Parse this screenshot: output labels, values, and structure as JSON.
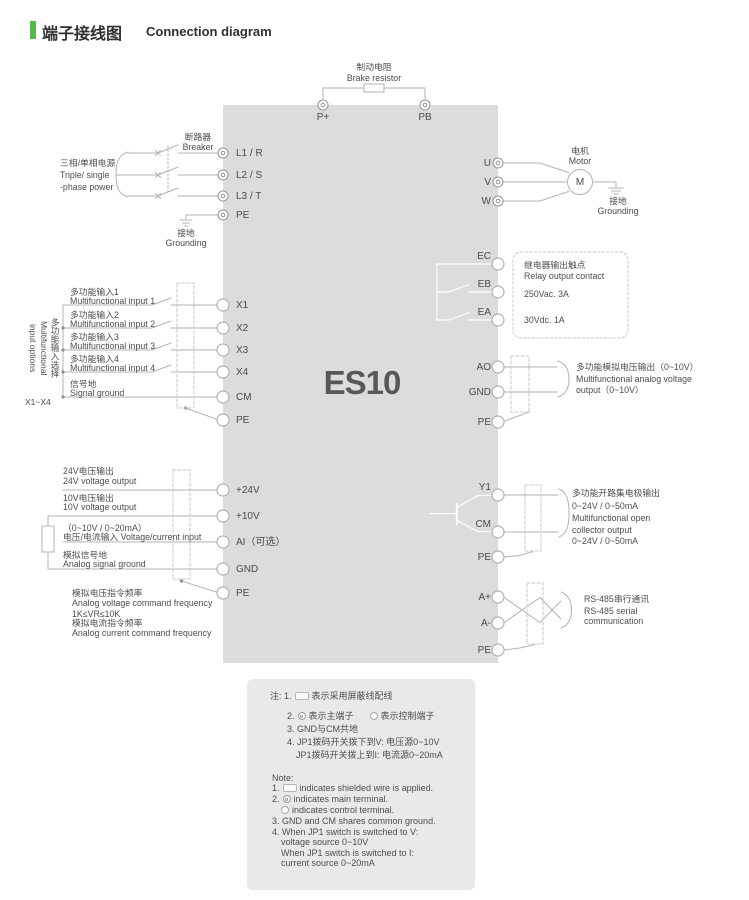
{
  "title": {
    "zh": "端子接线图",
    "en": "Connection diagram"
  },
  "device": {
    "model": "ES10"
  },
  "colors": {
    "accent": "#54b948",
    "device_box": "#dcdcdc",
    "notes_box": "#e9e9e9",
    "wire": "#b3b3b3",
    "text": "#4d4d4d"
  },
  "brake": {
    "zh": "制动电阻",
    "en": "Brake resistor",
    "p_plus": "P+",
    "pb": "PB"
  },
  "power": {
    "src_zh": "三相/单相电源",
    "src_en1": "Triple/ single",
    "src_en2": "-phase power",
    "breaker_zh": "断路器",
    "breaker_en": "Breaker",
    "l1": "L1 / R",
    "l2": "L2 / S",
    "l3": "L3 / T",
    "pe": "PE",
    "gnd_zh": "接地",
    "gnd_en": "Grounding"
  },
  "motor": {
    "u": "U",
    "v": "V",
    "w": "W",
    "zh": "电机",
    "en": "Motor",
    "symbol": "M",
    "gnd_zh": "接地",
    "gnd_en": "Grounding"
  },
  "inputs": {
    "side_label": "多功能输入选择\nMultifunctional\ninput options",
    "range": "X1~X4",
    "rows": [
      {
        "zh": "多功能输入1",
        "en": "Multifunctional input 1",
        "t": "X1"
      },
      {
        "zh": "多功能输入2",
        "en": "Multifunctional input 2",
        "t": "X2"
      },
      {
        "zh": "多功能输入3",
        "en": "Multifunctional input 3",
        "t": "X3"
      },
      {
        "zh": "多功能输入4",
        "en": "Multifunctional input 4",
        "t": "X4"
      },
      {
        "zh": "信号地",
        "en": "Signal ground",
        "t": "CM"
      }
    ],
    "pe": "PE"
  },
  "relay": {
    "ec": "EC",
    "eb": "EB",
    "ea": "EA",
    "zh": "继电器输出触点",
    "en": "Relay output contact",
    "ac": "250Vac. 3A",
    "dc": "30Vdc. 1A"
  },
  "analog_out": {
    "ao": "AO",
    "gnd": "GND",
    "pe": "PE",
    "zh": "多功能模拟电压输出（0~10V）",
    "en1": "Multifunctional analog voltage",
    "en2": "output（0~10V）"
  },
  "analog_in": {
    "rows": [
      {
        "zh": "24V电压输出",
        "en": "24V voltage output",
        "t": "+24V"
      },
      {
        "zh": "10V电压输出",
        "en": "10V voltage output",
        "t": "+10V"
      },
      {
        "zh": "（0~10V / 0~20mA）",
        "en": "电压/电流输入 Voltage/current input",
        "t": "AI（可选）"
      },
      {
        "zh": "模拟信号地",
        "en": "Analog signal ground",
        "t": "GND"
      }
    ],
    "pe": "PE",
    "freq1": "模拟电压指令频率",
    "freq2": "Analog voltage command frequency",
    "freq3": "1K≤VR≤10K",
    "freq4": "模拟电流指令频率",
    "freq5": "Analog current command frequency"
  },
  "collector": {
    "y1": "Y1",
    "cm": "CM",
    "pe": "PE",
    "l1": "多功能开路集电极输出",
    "l2": "0~24V / 0~50mA",
    "l3": "Multifunctional open",
    "l4": "collector output",
    "l5": "0~24V / 0~50mA"
  },
  "rs485": {
    "a_plus": "A+",
    "a_minus": "A-",
    "pe": "PE",
    "l1": "RS-485串行通讯",
    "l2": "RS-485 serial",
    "l3": "communication"
  },
  "notes": {
    "zh1a": "注: 1.",
    "zh1b": "表示采用屏蔽线配线",
    "zh2a": "2.",
    "zh2b": "表示主端子",
    "zh2c": "表示控制端子",
    "zh3": "3. GND与CM共地",
    "zh4": "4. JP1拨码开关拨下到V: 电压源0~10V",
    "zh5": "JP1拨码开关拨上到I: 电流源0~20mA",
    "en0": "Note:",
    "en1a": "1.",
    "en1b": "indicates shielded wire is applied.",
    "en2a": "2.",
    "en2b": "indicates main terminal.",
    "en3b": "indicates control terminal.",
    "en4": "3. GND and CM shares common ground.",
    "en5": "4. When JP1 switch is switched to V:",
    "en6": "voltage source 0~10V",
    "en7": "When JP1 switch is switched to I:",
    "en8": "current source 0~20mA"
  }
}
